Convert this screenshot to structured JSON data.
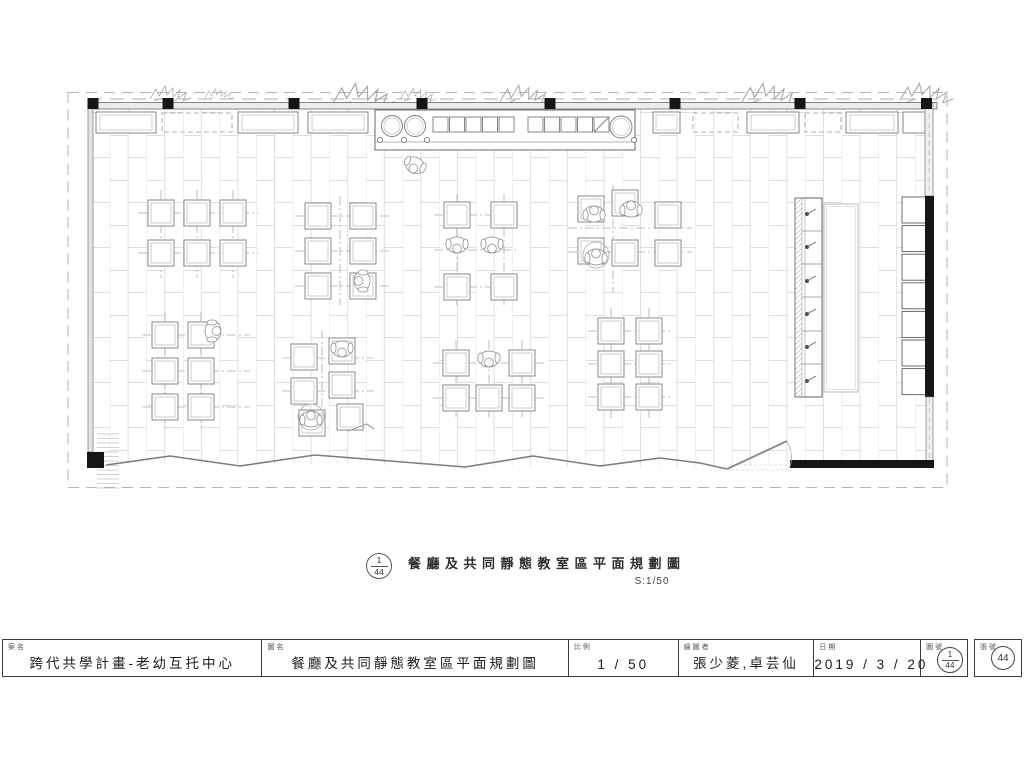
{
  "caption": {
    "ref_top": "1",
    "ref_bottom": "44",
    "title": "餐廳及共同靜態教室區平面規劃圖",
    "scale": "S:1/50"
  },
  "title_block": {
    "project_label": "案名",
    "project_value": "跨代共學計畫-老幼互托中心",
    "drawing_label": "圖名",
    "drawing_value": "餐廳及共同靜態教室區平面規劃圖",
    "scale_label": "比例",
    "scale_value": "1 / 50",
    "drafter_label": "繪圖者",
    "drafter_value": "張少菱,卓芸仙",
    "date_label": "日期",
    "date_value": "2019 / 3 / 20",
    "sheet_no_label": "圖號",
    "sheet_no_top": "1",
    "sheet_no_bottom": "44",
    "page_no_label": "張號",
    "page_no_value": "44"
  },
  "colors": {
    "ink": "#3a3a3a",
    "wall_black": "#161616",
    "light_line": "#aaaaaa",
    "tile_line": "#d4d4d4"
  }
}
